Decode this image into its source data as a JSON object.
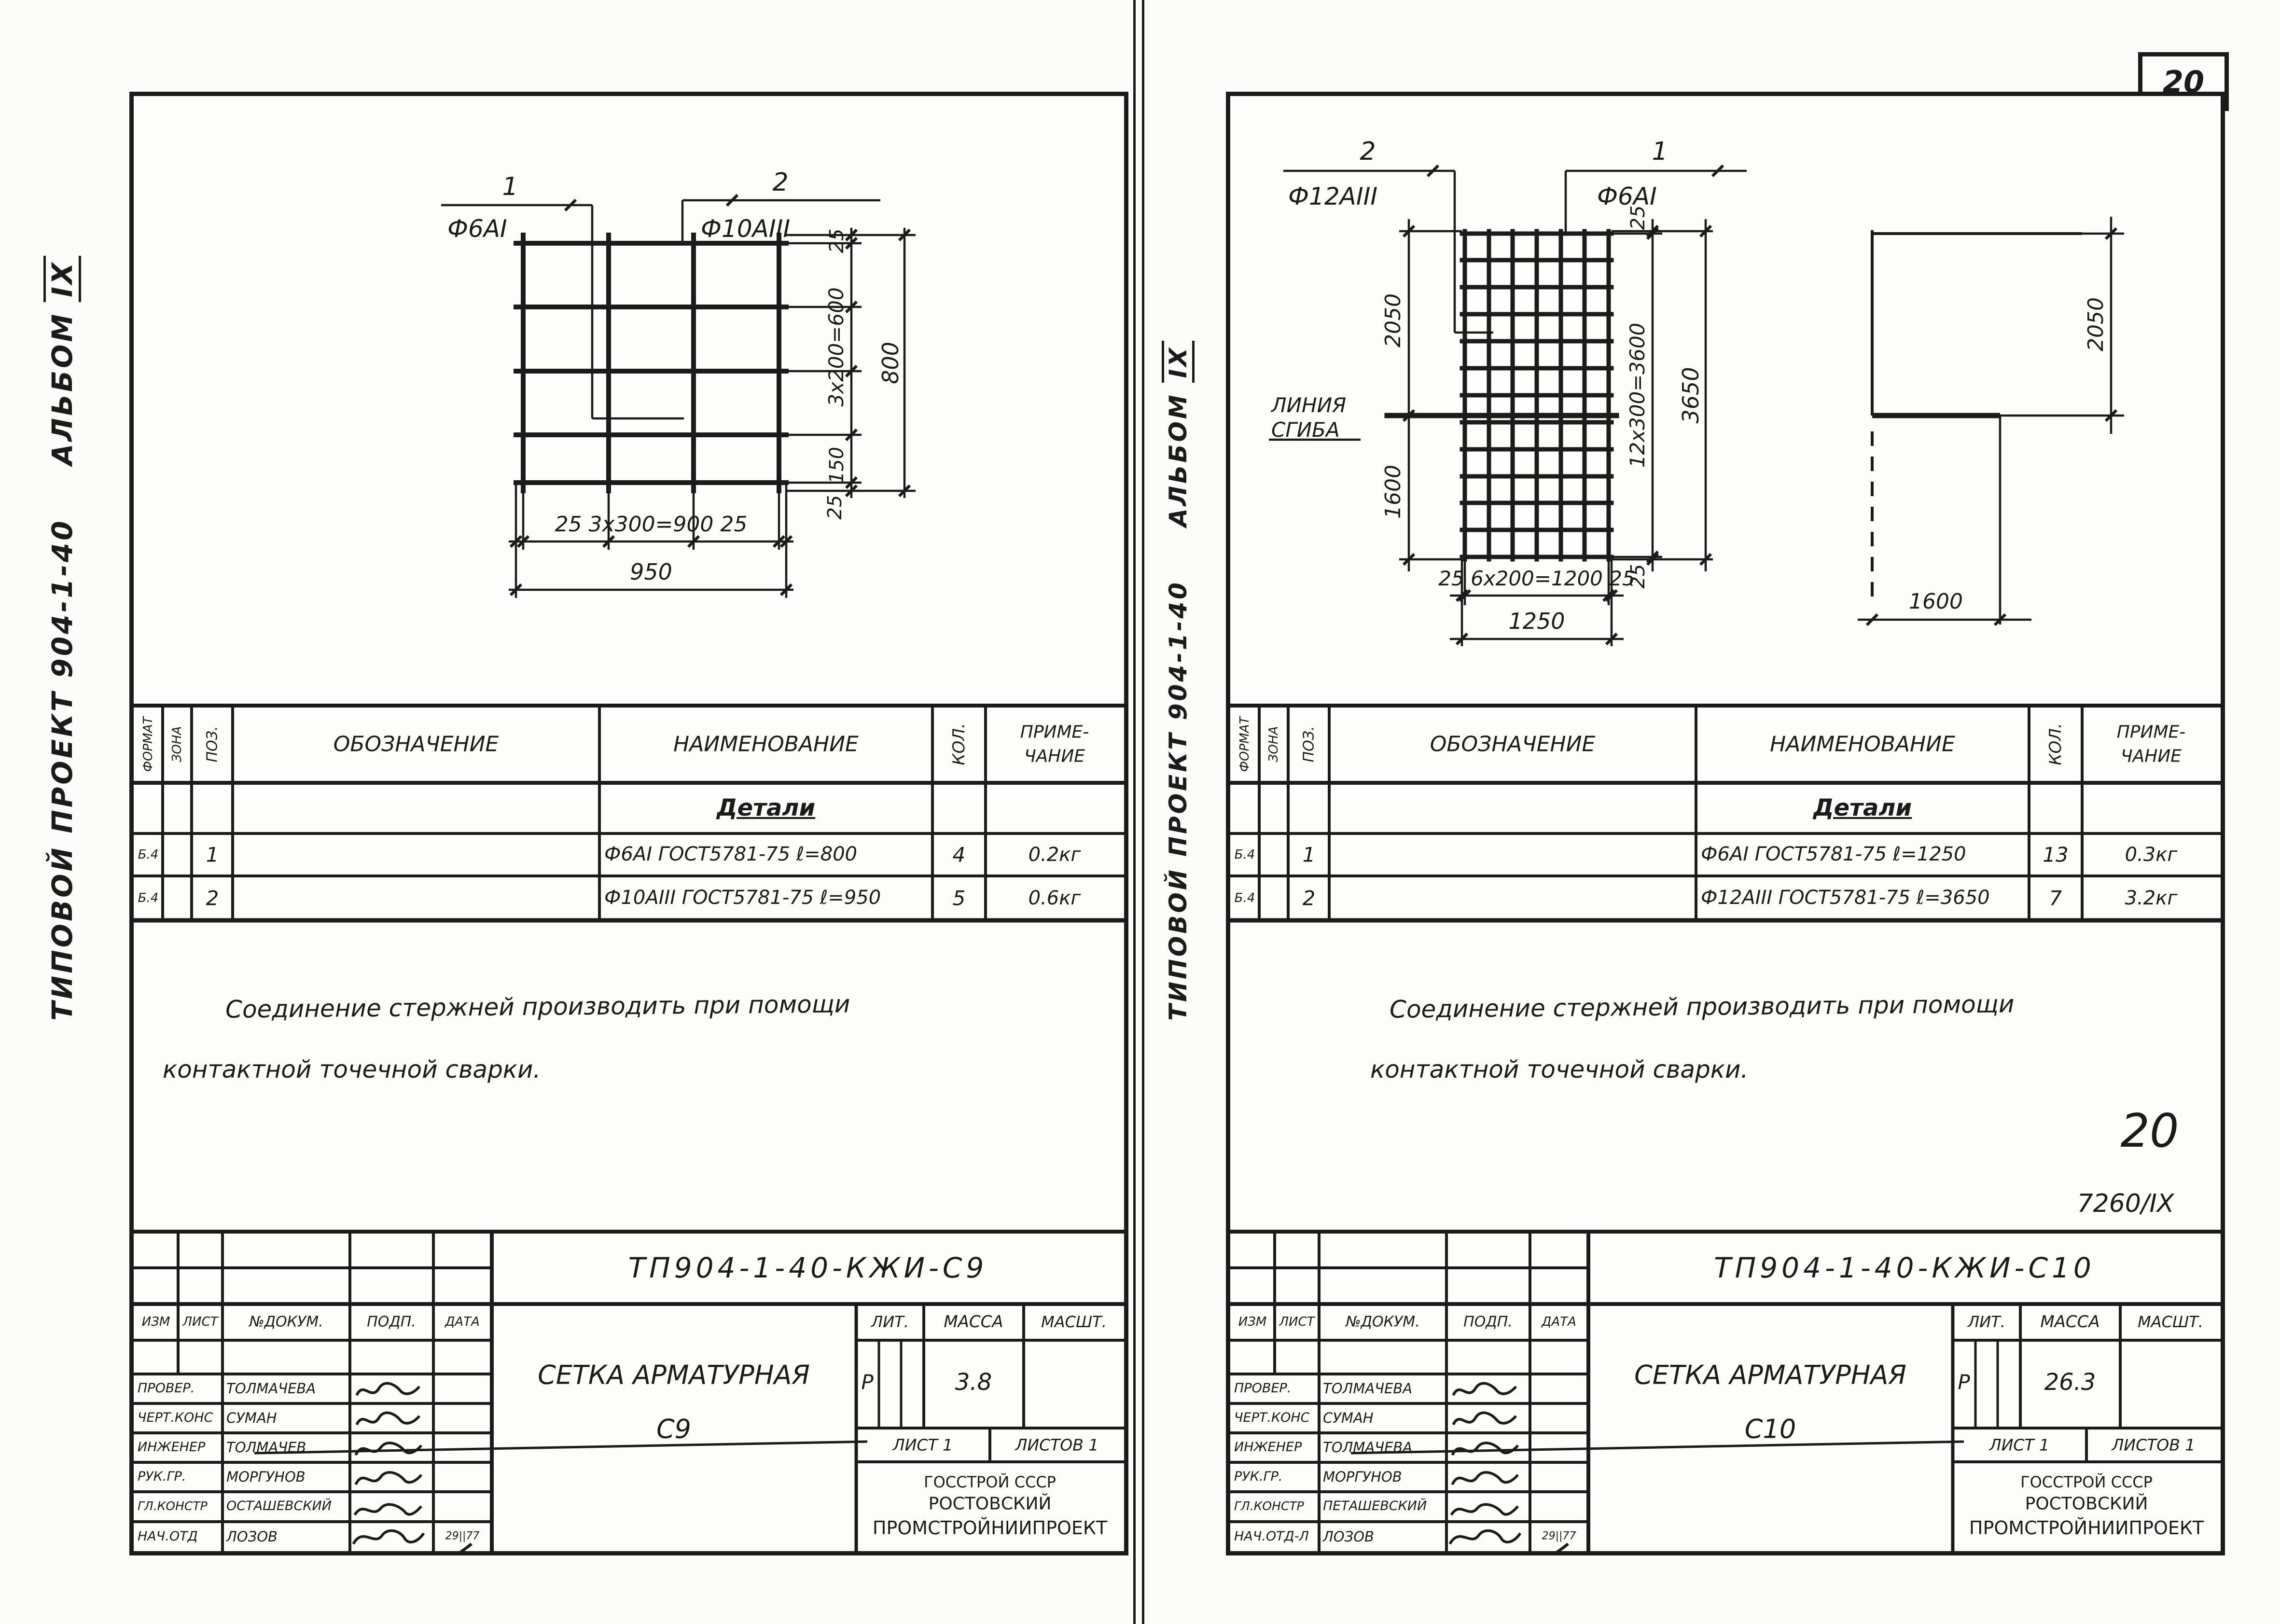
{
  "caption": {
    "main": "ТИПОВОЙ ПРОЕКТ 904-1-40",
    "album": "АЛЬБОМ",
    "num": "IX"
  },
  "page_badge": "20",
  "sched": {
    "format": "ФОРМАТ",
    "zone": "ЗОНА",
    "pos": "ПОЗ.",
    "desig": "ОБОЗНАЧЕНИЕ",
    "name": "НАИМЕНОВАНИЕ",
    "qty": "КОЛ.",
    "note1": "ПРИМЕ-",
    "note2": "ЧАНИЕ",
    "section": "Детали"
  },
  "tb": {
    "izm": "ИЗМ",
    "list": "ЛИСТ",
    "ndok": "№ДОКУМ.",
    "podp": "ПОДП.",
    "data": "ДАТА",
    "lit": "ЛИТ.",
    "mass": "МАССА",
    "scale": "МАСШТ.",
    "sheet": "ЛИСТ 1",
    "sheets": "ЛИСТОВ 1",
    "org1": "ГОССТРОЙ СССР",
    "org2": "РОСТОВСКИЙ",
    "org3": "ПРОМСТРОЙНИИПРОЕКТ",
    "date": "29||77"
  },
  "note": {
    "l1": "Соединение стержней производить при помощи",
    "l2": "контактной точечной сварки."
  },
  "left": {
    "c1": "1",
    "c1l": "Ф6АI",
    "c2": "2",
    "c2l": "Ф10АIII",
    "d_s1": "25",
    "d_s2": "3x200=600",
    "d_s3": "150",
    "d_s4": "25",
    "d_v": "800",
    "d_b": "25 3x300=900 25",
    "d_h": "950",
    "rows": [
      {
        "fmt": "Б.4",
        "pos": "1",
        "name": "Ф6АI ГОСТ5781-75 ℓ=800",
        "qty": "4",
        "note": "0.2кг"
      },
      {
        "fmt": "Б.4",
        "pos": "2",
        "name": "Ф10АIII ГОСТ5781-75 ℓ=950",
        "qty": "5",
        "note": "0.6кг"
      }
    ],
    "doc": "ТП904-1-40-КЖИ-С9",
    "t1": "СЕТКА АРМАТУРНАЯ",
    "t2": "С9",
    "lit": "Р",
    "mass": "3.8",
    "staff": [
      {
        "r": "ПРОВЕР.",
        "n": "ТОЛМАЧЕВА"
      },
      {
        "r": "ЧЕРТ.КОНС",
        "n": "СУМАН"
      },
      {
        "r": "ИНЖЕНЕР",
        "n": "ТОЛМАЧЕВ"
      },
      {
        "r": "РУК.ГР.",
        "n": "МОРГУНОВ"
      },
      {
        "r": "ГЛ.КОНСТР",
        "n": "ОСТАШЕВСКИЙ"
      },
      {
        "r": "НАЧ.ОТД",
        "n": "ЛОЗОВ"
      }
    ]
  },
  "right": {
    "c1": "1",
    "c1l": "Ф6АI",
    "c2": "2",
    "c2l": "Ф12АIII",
    "d_t": "25",
    "d_m": "12x300=3600",
    "d_bt": "25",
    "d_v": "3650",
    "d_lu": "2050",
    "d_ll": "1600",
    "d_b": "25 6x200=1200 25",
    "d_h": "1250",
    "bend1": "ЛИНИЯ",
    "bend2": "СГИБА",
    "p_v": "2050",
    "p_h": "1600",
    "rows": [
      {
        "fmt": "Б.4",
        "pos": "1",
        "name": "Ф6АI ГОСТ5781-75 ℓ=1250",
        "qty": "13",
        "note": "0.3кг"
      },
      {
        "fmt": "Б.4",
        "pos": "2",
        "name": "Ф12АIII ГОСТ5781-75 ℓ=3650",
        "qty": "7",
        "note": "3.2кг"
      }
    ],
    "doc": "ТП904-1-40-КЖИ-С10",
    "t1": "СЕТКА АРМАТУРНАЯ",
    "t2": "С10",
    "lit": "Р",
    "mass": "26.3",
    "page_num": "20",
    "code": "7260/IX",
    "staff": [
      {
        "r": "ПРОВЕР.",
        "n": "ТОЛМАЧЕВА"
      },
      {
        "r": "ЧЕРТ.КОНС",
        "n": "СУМАН"
      },
      {
        "r": "ИНЖЕНЕР",
        "n": "ТОЛМАЧЕВА"
      },
      {
        "r": "РУК.ГР.",
        "n": "МОРГУНОВ"
      },
      {
        "r": "ГЛ.КОНСТР",
        "n": "ПЕТАШЕВСКИЙ"
      },
      {
        "r": "НАЧ.ОТД-Л",
        "n": "ЛОЗОВ"
      }
    ]
  }
}
